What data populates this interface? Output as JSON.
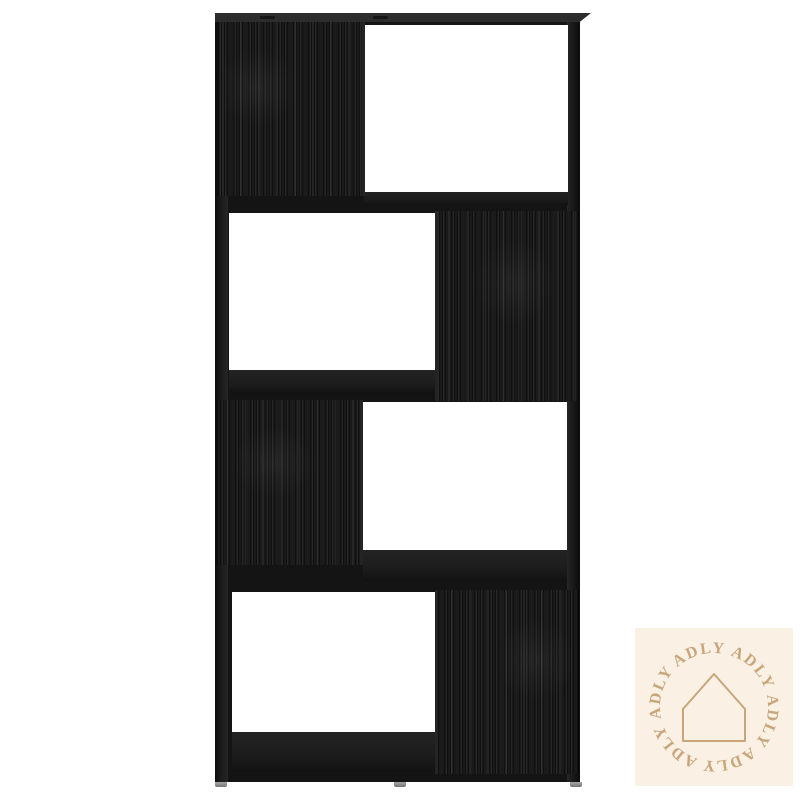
{
  "image": {
    "type": "product-photo",
    "subject": "4-tier zigzag room-divider bookcase in black wood grain, front view on white background",
    "background_color": "#ffffff"
  },
  "shelf": {
    "base_color": "#141414",
    "grain_color": "#1a1a1a",
    "top_face_color": "#2c2c2c",
    "foot_color": "#8f8f8f",
    "tiers": [
      {
        "panel_side": "left",
        "open_side": "right"
      },
      {
        "panel_side": "right",
        "open_side": "left"
      },
      {
        "panel_side": "left",
        "open_side": "right"
      },
      {
        "panel_side": "right",
        "open_side": "left"
      }
    ]
  },
  "watermark": {
    "brand": "ADLY",
    "bg_color": "#faf0e3",
    "accent_color": "#c8a67c",
    "icon": "house-outline",
    "ring_words": [
      "ADLY",
      "ADLY",
      "ADLY",
      "ADLY",
      "ADLY",
      "ADLY"
    ]
  }
}
